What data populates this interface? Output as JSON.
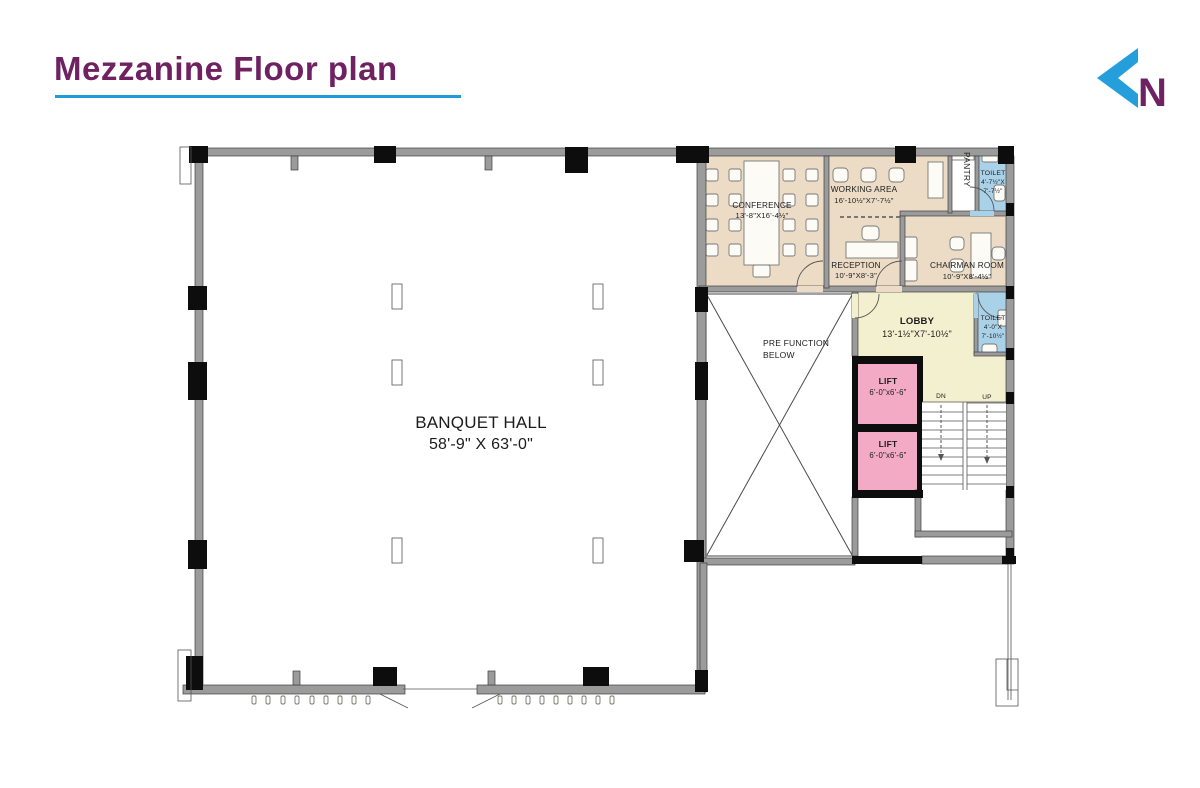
{
  "header": {
    "title": "Mezzanine Floor plan",
    "logo_letter": "N"
  },
  "colors": {
    "title": "#6E2262",
    "underline": "#1F9CD8",
    "logo_blue": "#259FDB",
    "room_beige": "#ECDCC6",
    "room_yellow": "#F3F0CF",
    "room_blue": "#A9D2E9",
    "room_pink": "#F3ABC5",
    "wall_gray": "#9B9B9B",
    "column_black": "#0D0D0D"
  },
  "rooms": {
    "banquet_hall": {
      "name": "BANQUET HALL",
      "dims": "58'-9\" X 63'-0\""
    },
    "conference": {
      "name": "CONFERENCE",
      "dims": "13'-8\"X16'-4½\""
    },
    "working_area": {
      "name": "WORKING AREA",
      "dims": "16'-10½\"X7'-7½\""
    },
    "pantry": {
      "name": "PANTRY"
    },
    "toilet_top": {
      "name": "TOILET",
      "dims_line1": "4'-7½\"X",
      "dims_line2": "7'-7½\""
    },
    "reception": {
      "name": "RECEPTION",
      "dims": "10'-9\"X8'-3\""
    },
    "chairman_room": {
      "name": "CHAIRMAN ROOM",
      "dims": "10'-9\"X8'-4½\""
    },
    "lobby": {
      "name": "LOBBY",
      "dims": "13'-1½\"X7'-10½\""
    },
    "toilet_lobby": {
      "name": "TOILET",
      "dims_line1": "4'-0\"X",
      "dims_line2": "7'-10½\""
    },
    "lift_upper": {
      "name": "LIFT",
      "dims": "6'-0\"x6'-6\""
    },
    "lift_lower": {
      "name": "LIFT",
      "dims": "6'-0\"x6'-6\""
    },
    "pre_function": {
      "line1": "PRE FUNCTION",
      "line2": "BELOW"
    },
    "stairs": {
      "down_label": "DN",
      "up_label": "UP"
    }
  }
}
